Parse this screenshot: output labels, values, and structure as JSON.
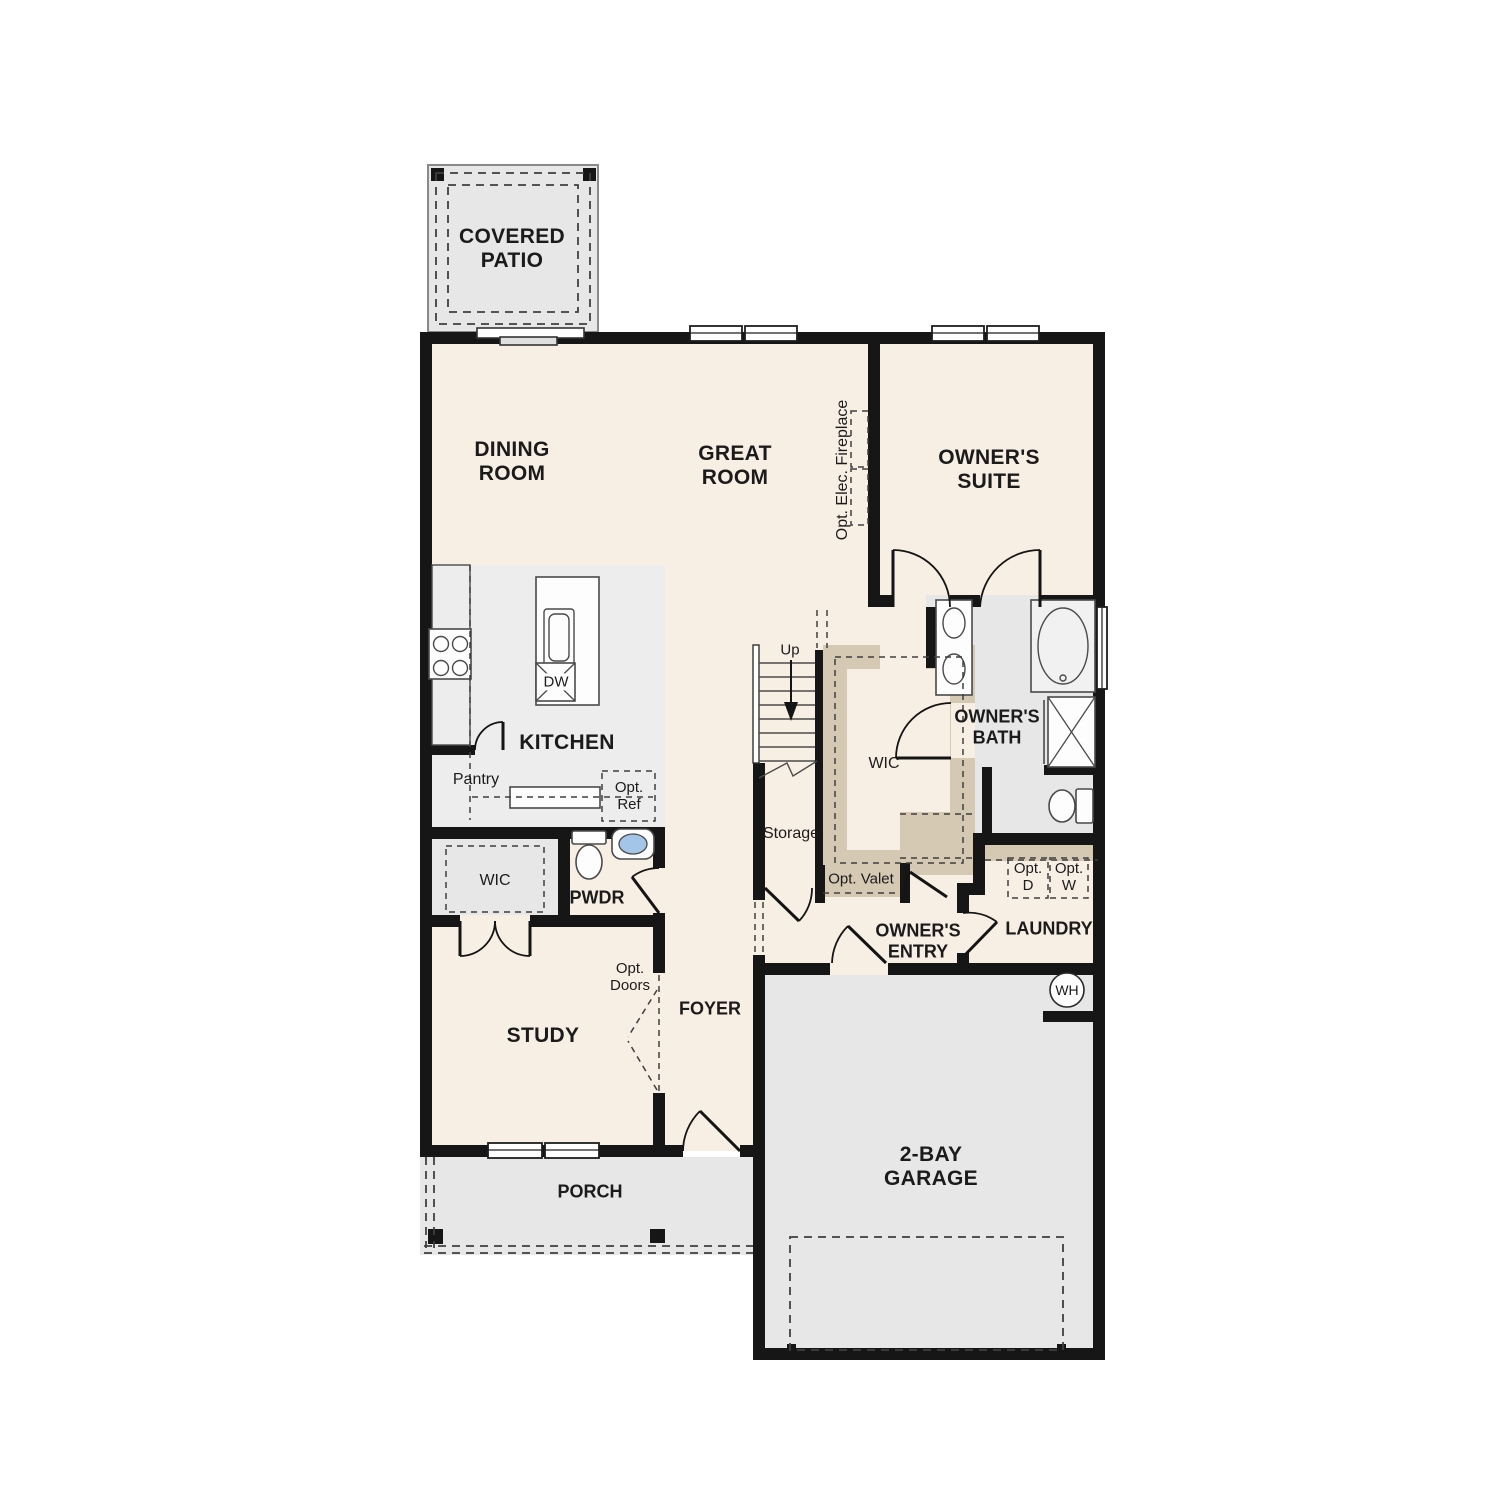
{
  "colors": {
    "wall": "#161616",
    "room": "#f8efe4",
    "hard": "#e7e7e7",
    "hard2": "#ededed",
    "tan": "#d5c9b3",
    "water": "#a3c6e8",
    "line": "#4a4a4a",
    "page": "#ffffff"
  },
  "labels": {
    "covered_patio": "COVERED PATIO",
    "dining_room": "DINING ROOM",
    "great_room": "GREAT ROOM",
    "owners_suite": "OWNER'S SUITE",
    "opt_elec_fireplace": "Opt. Elec. Fireplace",
    "kitchen": "KITCHEN",
    "dishwasher": "DW",
    "pantry": "Pantry",
    "opt_ref": "Opt. Ref",
    "stairs_up": "Up",
    "storage": "Storage",
    "wic_primary": "WIC",
    "owners_bath": "OWNER'S BATH",
    "opt_valet": "Opt. Valet",
    "wic_hall": "WIC",
    "powder": "PWDR",
    "owners_entry": "OWNER'S ENTRY",
    "laundry": "LAUNDRY",
    "opt_dryer": "Opt. D",
    "opt_washer": "Opt. W",
    "water_heater": "WH",
    "opt_doors": "Opt. Doors",
    "foyer": "FOYER",
    "study": "STUDY",
    "porch": "PORCH",
    "garage": "2-BAY GARAGE"
  }
}
